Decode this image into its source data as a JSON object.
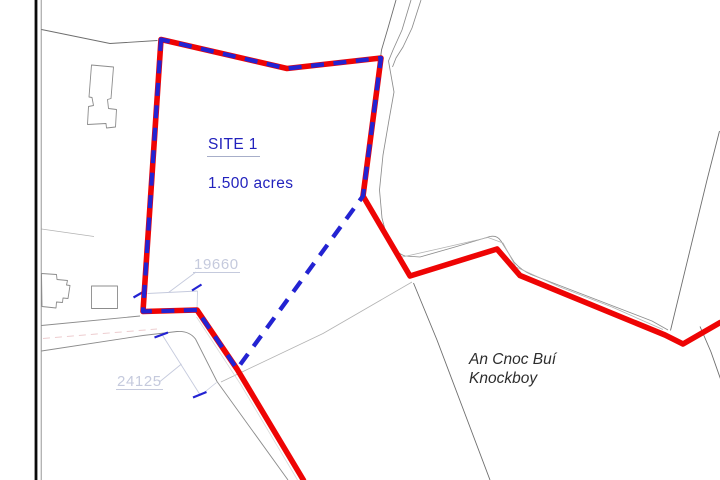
{
  "map": {
    "site": {
      "label": "SITE 1",
      "area": "1.500 acres"
    },
    "dimensions": {
      "boundary_south": "19660",
      "road_frontage": "24125"
    },
    "townland": {
      "irish": "An Cnoc Buí",
      "english": "Knockboy"
    }
  },
  "colors": {
    "red": "#ee0404",
    "blue": "#2323d2",
    "text_blue": "#2222bd",
    "dim": "#c5cadd",
    "gray_dark": "#6e6e6e",
    "gray": "#8c8c8c",
    "gray_light": "#b3b3b3",
    "faint": "#d9d9d9",
    "pink": "#e6b6ba",
    "ink": "#2d2d2d",
    "black": "#0b0b0b"
  }
}
